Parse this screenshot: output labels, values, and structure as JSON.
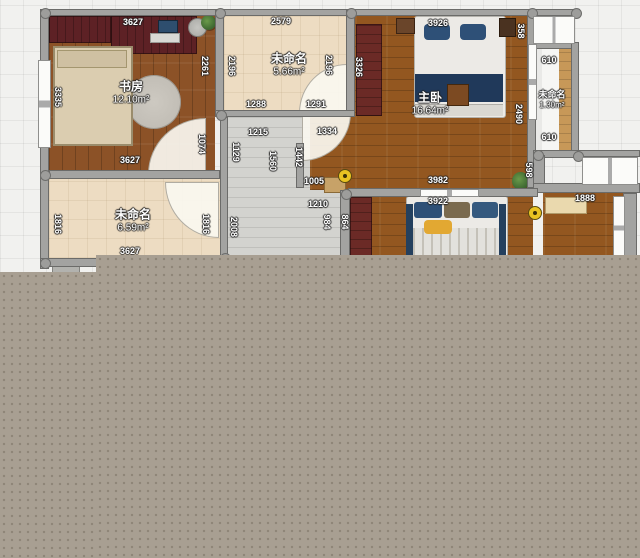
{
  "rooms": [
    {
      "name": "书房",
      "area": "12.10m²"
    },
    {
      "name": "未命名",
      "area": "5.66m²"
    },
    {
      "name": "主卧",
      "area": "16.64m²"
    },
    {
      "name": "未命名",
      "area": "1.30m²"
    },
    {
      "name": "未命名",
      "area": "6.59m²"
    }
  ],
  "dimensions_horizontal": [
    {
      "label": "3627",
      "x": 133,
      "y": 22
    },
    {
      "label": "2579",
      "x": 281,
      "y": 21
    },
    {
      "label": "3926",
      "x": 438,
      "y": 23
    },
    {
      "label": "1288",
      "x": 256,
      "y": 104
    },
    {
      "label": "1291",
      "x": 316,
      "y": 104
    },
    {
      "label": "610",
      "x": 549,
      "y": 60
    },
    {
      "label": "610",
      "x": 549,
      "y": 137
    },
    {
      "label": "1215",
      "x": 258,
      "y": 132
    },
    {
      "label": "1334",
      "x": 327,
      "y": 131
    },
    {
      "label": "1005",
      "x": 314,
      "y": 181
    },
    {
      "label": "3982",
      "x": 438,
      "y": 180
    },
    {
      "label": "1210",
      "x": 318,
      "y": 204
    },
    {
      "label": "3922",
      "x": 438,
      "y": 201
    },
    {
      "label": "1888",
      "x": 585,
      "y": 198
    },
    {
      "label": "3627",
      "x": 130,
      "y": 160
    },
    {
      "label": "3627",
      "x": 130,
      "y": 251
    }
  ],
  "dimensions_vertical": [
    {
      "label": "3335",
      "x": 58,
      "y": 97
    },
    {
      "label": "2261",
      "x": 205,
      "y": 66
    },
    {
      "label": "2196",
      "x": 232,
      "y": 66
    },
    {
      "label": "2196",
      "x": 329,
      "y": 65
    },
    {
      "label": "3326",
      "x": 359,
      "y": 67
    },
    {
      "label": "358",
      "x": 521,
      "y": 31
    },
    {
      "label": "2490",
      "x": 519,
      "y": 114
    },
    {
      "label": "598",
      "x": 529,
      "y": 170
    },
    {
      "label": "1074",
      "x": 202,
      "y": 144
    },
    {
      "label": "1129",
      "x": 236,
      "y": 152
    },
    {
      "label": "1560",
      "x": 273,
      "y": 161
    },
    {
      "label": "1442",
      "x": 299,
      "y": 157
    },
    {
      "label": "984",
      "x": 327,
      "y": 222
    },
    {
      "label": "864",
      "x": 345,
      "y": 222
    },
    {
      "label": "2008",
      "x": 234,
      "y": 227
    },
    {
      "label": "1816",
      "x": 58,
      "y": 224
    },
    {
      "label": "1816",
      "x": 206,
      "y": 224
    }
  ],
  "colors": {
    "overlay": "#a89f92",
    "wall": "#a3a3a1",
    "wood_dark": "#8c5227",
    "wood_master": "#935720",
    "cream_floor": "#eddcc2",
    "corridor_floor": "#d3d3cf",
    "lock_accent": "#e9c322",
    "bed_navy": "#2e5077"
  },
  "icons": {
    "door_lock": "door-lock-icon",
    "plant": "plant-icon"
  }
}
